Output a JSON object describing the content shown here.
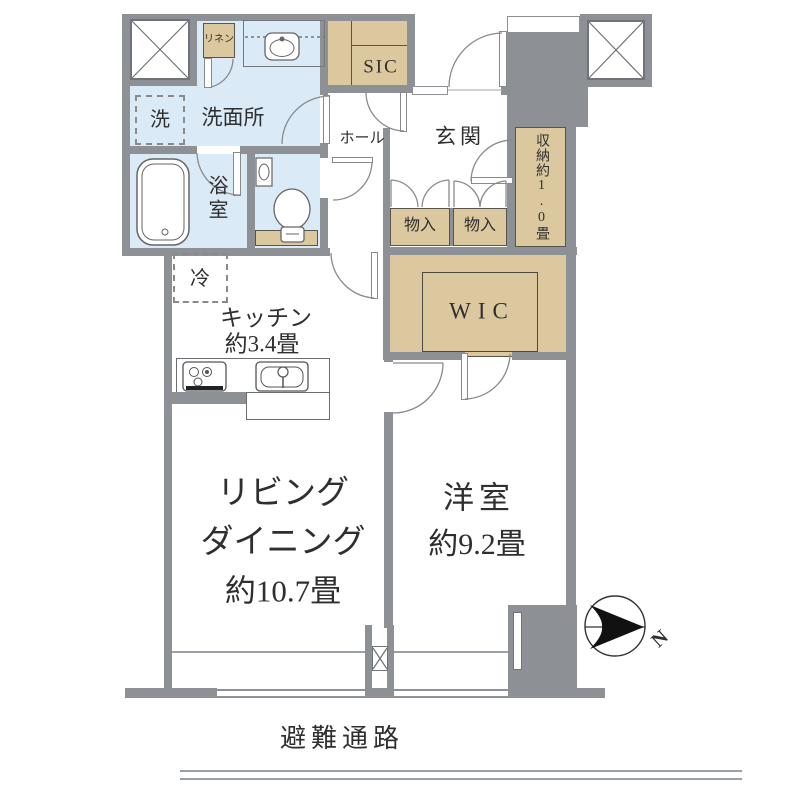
{
  "title": "apartment-floor-plan",
  "colors": {
    "wall": "#8d9095",
    "wet_area": "#daeaf7",
    "storage_area": "#dcc89e",
    "text": "#2f2f2f"
  },
  "labels": {
    "linen_closet": "リネン",
    "washing_machine": "洗",
    "washroom": "洗面所",
    "shoe_closet": "SIC",
    "hall": "ホール",
    "entrance": "玄関",
    "closet_left": "物入",
    "closet_right": "物入",
    "storage_one": "収納約1.0畳",
    "bathroom": "浴室",
    "wic": "WIC",
    "refrigerator": "冷",
    "kitchen_line1": "キッチン",
    "kitchen_line2": "約3.4畳",
    "living_line1": "リビング",
    "living_line2": "ダイニング",
    "living_line3": "約10.7畳",
    "western_room_line1": "洋室",
    "western_room_line2": "約9.2畳",
    "evacuation_route": "避難通路",
    "north": "N"
  }
}
